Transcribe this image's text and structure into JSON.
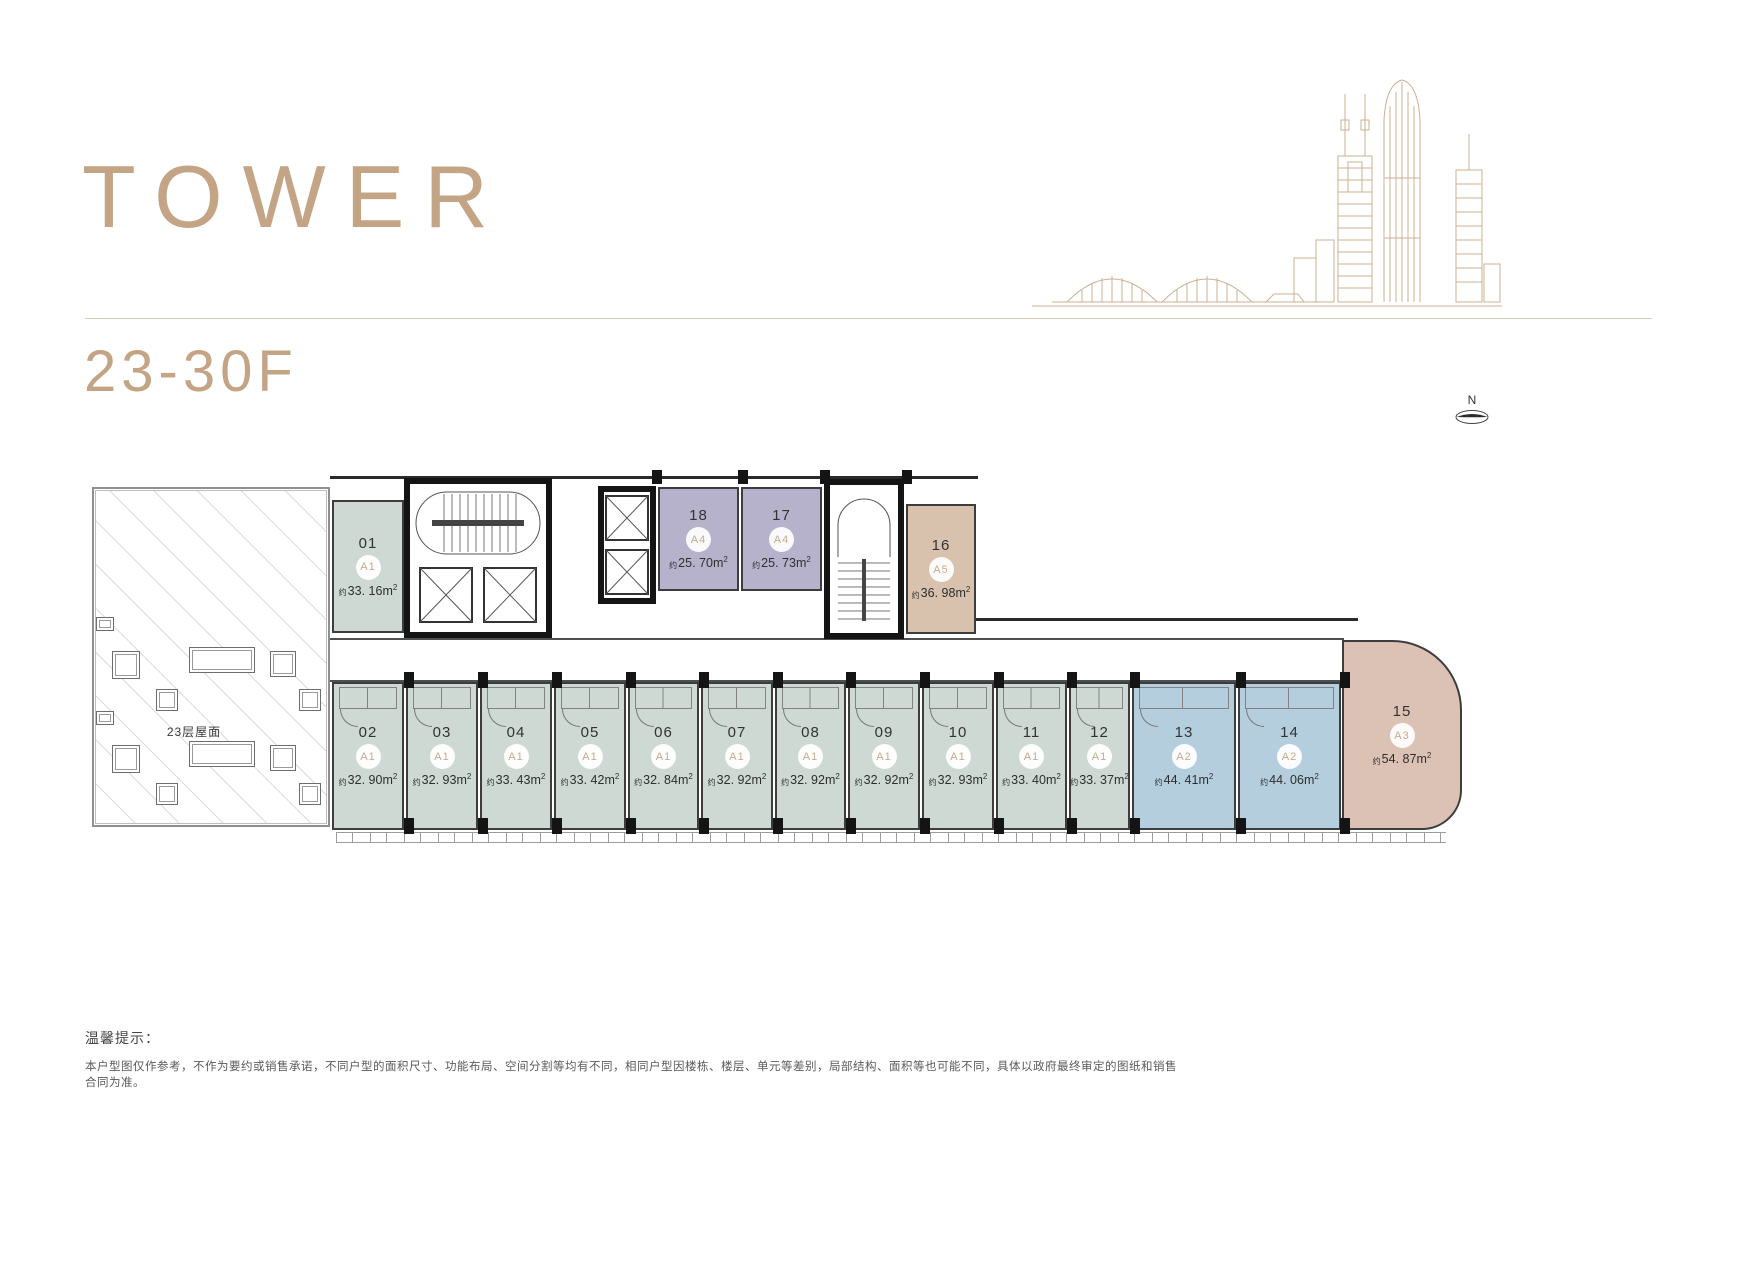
{
  "header": {
    "title": "TOWER",
    "floor_range": "23-30F"
  },
  "compass": {
    "label": "N"
  },
  "plan": {
    "terrace_label": "23层屋面",
    "area_prefix": "约",
    "area_unit": "m",
    "area_sup": "2"
  },
  "units": [
    {
      "number": "01",
      "type": "A1",
      "area": "33. 16"
    },
    {
      "number": "18",
      "type": "A4",
      "area": "25. 70"
    },
    {
      "number": "17",
      "type": "A4",
      "area": "25. 73"
    },
    {
      "number": "16",
      "type": "A5",
      "area": "36. 98"
    },
    {
      "number": "02",
      "type": "A1",
      "area": "32. 90"
    },
    {
      "number": "03",
      "type": "A1",
      "area": "32. 93"
    },
    {
      "number": "04",
      "type": "A1",
      "area": "33. 43"
    },
    {
      "number": "05",
      "type": "A1",
      "area": "33. 42"
    },
    {
      "number": "06",
      "type": "A1",
      "area": "32. 84"
    },
    {
      "number": "07",
      "type": "A1",
      "area": "32. 92"
    },
    {
      "number": "08",
      "type": "A1",
      "area": "32. 92"
    },
    {
      "number": "09",
      "type": "A1",
      "area": "32. 92"
    },
    {
      "number": "10",
      "type": "A1",
      "area": "32. 93"
    },
    {
      "number": "11",
      "type": "A1",
      "area": "33. 40"
    },
    {
      "number": "12",
      "type": "A1",
      "area": "33. 37"
    },
    {
      "number": "13",
      "type": "A2",
      "area": "44. 41"
    },
    {
      "number": "14",
      "type": "A2",
      "area": "44. 06"
    },
    {
      "number": "15",
      "type": "A3",
      "area": "54. 87"
    }
  ],
  "colors": {
    "brand": "#c3a485",
    "type_a1": "#cdd9d2",
    "type_a2": "#b5cedd",
    "type_a3": "#dcc1b5",
    "type_a4": "#b6b2cb",
    "type_a5": "#d8c2ad",
    "wall": "#1a1a1a"
  },
  "footer": {
    "notice_title": "温馨提示：",
    "disclaimer": "本户型图仅作参考，不作为要约或销售承诺，不同户型的面积尺寸、功能布局、空间分割等均有不同，相同户型因楼栋、楼层、单元等差别，局部结构、面积等也可能不同，具体以政府最终审定的图纸和销售合同为准。"
  }
}
